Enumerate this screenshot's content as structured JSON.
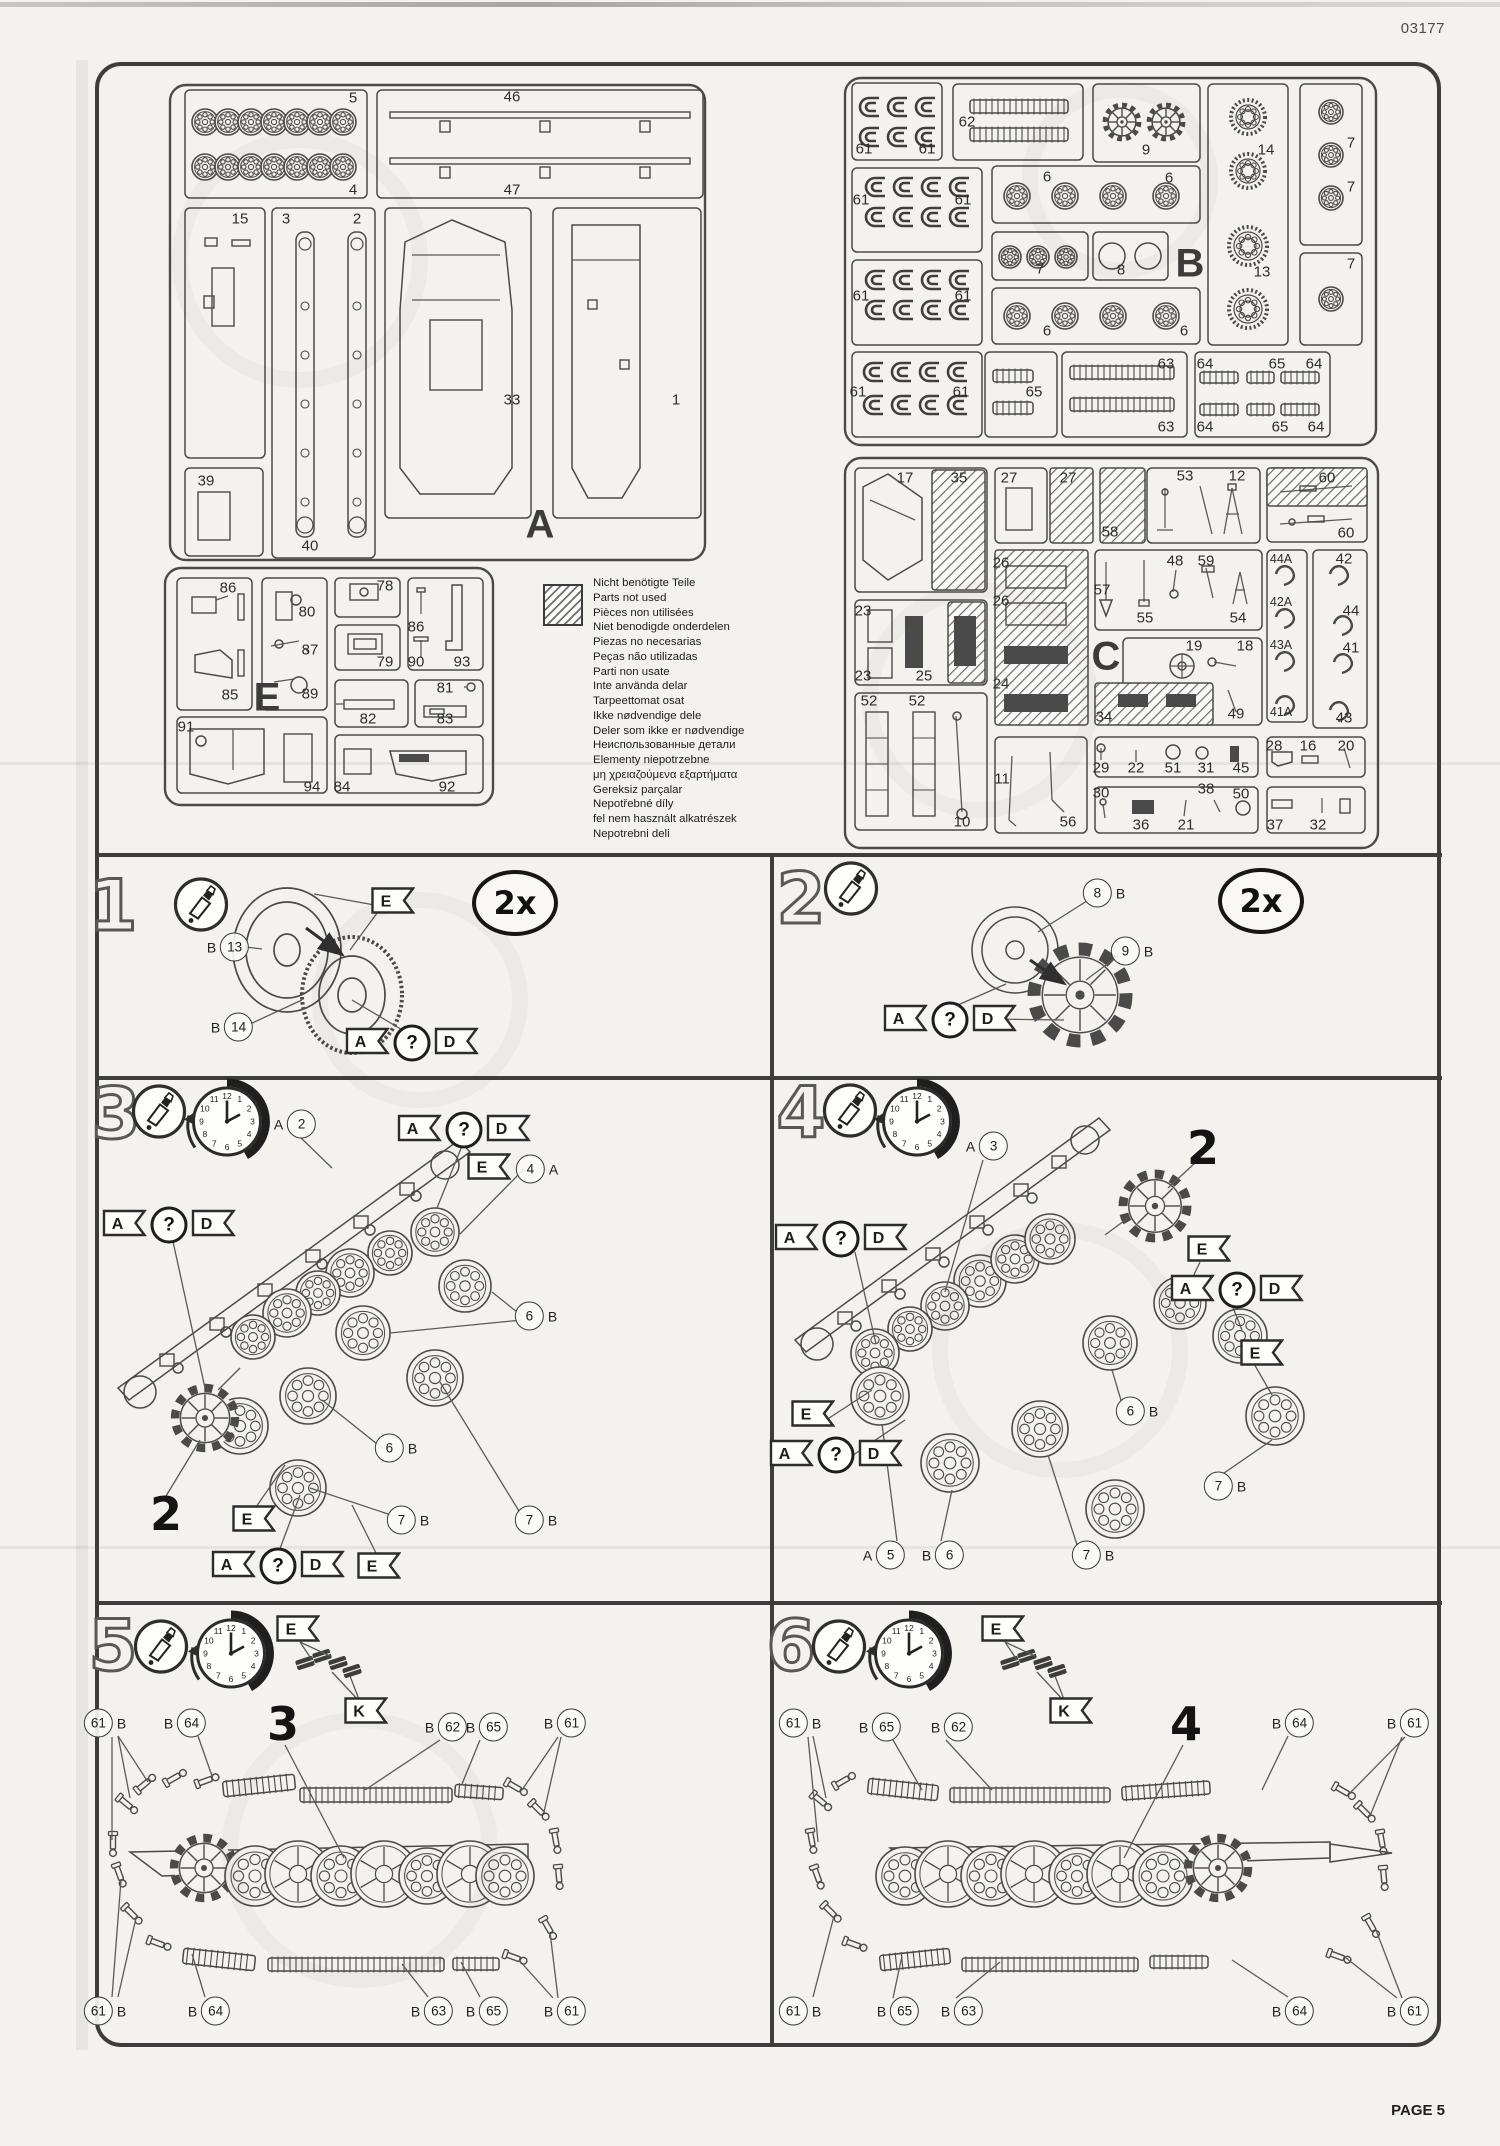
{
  "page": {
    "kit_number": "03177",
    "page_label": "PAGE 5"
  },
  "colors": {
    "paper": "#f4f2ee",
    "ink": "#3d3d3d"
  },
  "legend": {
    "icon": "hatched-square",
    "lines": [
      "Nicht benötigte Teile",
      "Parts not used",
      "Pièces non utilisées",
      "Niet benodigde onderdelen",
      "Piezas no necesarias",
      "Peças não utilizadas",
      "Parti non usate",
      "Inte använda delar",
      "Tarpeettomat osat",
      "Ikke nødvendige dele",
      "Deler som ikke er nødvendige",
      "Неиспользованные детали",
      "Elementy niepotrzebne",
      "μη χρειαζούμενα εξαρτήματα",
      "Gereksiz parçalar",
      "Nepotřebné díly",
      "fel nem használt alkatrészek",
      "Nepotrebni deli"
    ]
  },
  "sprues": [
    {
      "id": "A",
      "letter": "A",
      "lx": 540,
      "ly": 525,
      "labels": [
        [
          "5",
          353,
          98
        ],
        [
          "4",
          353,
          190
        ],
        [
          "46",
          512,
          97
        ],
        [
          "47",
          512,
          190
        ],
        [
          "15",
          240,
          219
        ],
        [
          "3",
          286,
          219
        ],
        [
          "2",
          357,
          219
        ],
        [
          "33",
          512,
          400
        ],
        [
          "1",
          676,
          400
        ],
        [
          "39",
          206,
          481
        ],
        [
          "40",
          310,
          546
        ]
      ]
    },
    {
      "id": "B",
      "letter": "B",
      "lx": 1190,
      "ly": 264,
      "labels": [
        [
          "61",
          864,
          149
        ],
        [
          "61",
          927,
          149
        ],
        [
          "62",
          967,
          122
        ],
        [
          "9",
          1146,
          150
        ],
        [
          "14",
          1266,
          150
        ],
        [
          "13",
          1262,
          272
        ],
        [
          "7",
          1351,
          143
        ],
        [
          "7",
          1351,
          187
        ],
        [
          "7",
          1351,
          264
        ],
        [
          "61",
          861,
          200
        ],
        [
          "61",
          963,
          200
        ],
        [
          "6",
          1047,
          177
        ],
        [
          "6",
          1169,
          178
        ],
        [
          "7",
          1040,
          269
        ],
        [
          "8",
          1121,
          270
        ],
        [
          "61",
          861,
          296
        ],
        [
          "61",
          963,
          296
        ],
        [
          "6",
          1047,
          331
        ],
        [
          "6",
          1184,
          331
        ],
        [
          "61",
          858,
          392
        ],
        [
          "61",
          961,
          392
        ],
        [
          "65",
          1034,
          392
        ],
        [
          "63",
          1166,
          364
        ],
        [
          "63",
          1166,
          427
        ],
        [
          "64",
          1205,
          364
        ],
        [
          "65",
          1277,
          364
        ],
        [
          "64",
          1314,
          364
        ],
        [
          "64",
          1205,
          427
        ],
        [
          "65",
          1280,
          427
        ],
        [
          "64",
          1316,
          427
        ]
      ]
    },
    {
      "id": "C",
      "letter": "C",
      "lx": 1106,
      "ly": 657,
      "labels": [
        [
          "17",
          905,
          478
        ],
        [
          "35",
          959,
          478
        ],
        [
          "27",
          1009,
          478
        ],
        [
          "27",
          1068,
          478
        ],
        [
          "58",
          1110,
          532
        ],
        [
          "53",
          1185,
          476
        ],
        [
          "12",
          1237,
          476
        ],
        [
          "60",
          1327,
          478
        ],
        [
          "60",
          1346,
          533
        ],
        [
          "23",
          863,
          611
        ],
        [
          "23",
          863,
          676
        ],
        [
          "25",
          924,
          676
        ],
        [
          "26",
          1001,
          563
        ],
        [
          "26",
          1001,
          601
        ],
        [
          "24",
          1001,
          684
        ],
        [
          "57",
          1102,
          590
        ],
        [
          "48",
          1175,
          561
        ],
        [
          "59",
          1206,
          561
        ],
        [
          "55",
          1145,
          618
        ],
        [
          "54",
          1238,
          618
        ],
        [
          "19",
          1194,
          646
        ],
        [
          "18",
          1245,
          646
        ],
        [
          "49",
          1236,
          714
        ],
        [
          "34",
          1104,
          717
        ],
        [
          "52",
          869,
          701
        ],
        [
          "52",
          917,
          701
        ],
        [
          "10",
          962,
          822
        ],
        [
          "11",
          1002,
          779
        ],
        [
          "56",
          1068,
          822
        ],
        [
          "29",
          1101,
          768
        ],
        [
          "22",
          1136,
          768
        ],
        [
          "51",
          1173,
          768
        ],
        [
          "31",
          1206,
          768
        ],
        [
          "45",
          1241,
          768
        ],
        [
          "28",
          1274,
          746
        ],
        [
          "16",
          1308,
          746
        ],
        [
          "20",
          1346,
          746
        ],
        [
          "30",
          1101,
          793
        ],
        [
          "38",
          1206,
          789
        ],
        [
          "50",
          1241,
          794
        ],
        [
          "36",
          1141,
          825
        ],
        [
          "21",
          1186,
          825
        ],
        [
          "37",
          1275,
          825
        ],
        [
          "32",
          1318,
          825
        ],
        [
          "44A",
          1281,
          559
        ],
        [
          "42A",
          1281,
          602
        ],
        [
          "43A",
          1281,
          645
        ],
        [
          "41A",
          1281,
          712
        ],
        [
          "42",
          1344,
          559
        ],
        [
          "44",
          1351,
          611
        ],
        [
          "41",
          1351,
          648
        ],
        [
          "43",
          1344,
          718
        ]
      ]
    },
    {
      "id": "E",
      "letter": "E",
      "lx": 267,
      "ly": 698,
      "labels": [
        [
          "86",
          228,
          588
        ],
        [
          "85",
          230,
          695
        ],
        [
          "80",
          307,
          612
        ],
        [
          "87",
          310,
          650
        ],
        [
          "89",
          310,
          694
        ],
        [
          "78",
          385,
          586
        ],
        [
          "79",
          385,
          662
        ],
        [
          "86",
          416,
          627
        ],
        [
          "90",
          416,
          662
        ],
        [
          "93",
          462,
          662
        ],
        [
          "82",
          368,
          719
        ],
        [
          "81",
          445,
          688
        ],
        [
          "83",
          445,
          719
        ],
        [
          "91",
          186,
          727
        ],
        [
          "94",
          312,
          787
        ],
        [
          "84",
          342,
          787
        ],
        [
          "92",
          447,
          787
        ]
      ]
    }
  ],
  "steps": [
    {
      "n": "1",
      "items": [
        {
          "k": "num",
          "t": "1",
          "x": 113,
          "y": 906
        },
        {
          "k": "glue",
          "x": 201,
          "y": 907
        },
        {
          "k": "callout",
          "pre": "B",
          "num": "13",
          "x": 228,
          "y": 947
        },
        {
          "k": "callout",
          "pre": "B",
          "num": "14",
          "x": 232,
          "y": 1027
        },
        {
          "k": "flag",
          "letters": [
            "E"
          ],
          "x": 393,
          "y": 903
        },
        {
          "k": "flag",
          "letters": [
            "A",
            "?",
            "D"
          ],
          "x": 412,
          "y": 1043
        },
        {
          "k": "mult",
          "t": "2x",
          "x": 515,
          "y": 903
        }
      ]
    },
    {
      "n": "2",
      "items": [
        {
          "k": "num",
          "t": "2",
          "x": 801,
          "y": 899
        },
        {
          "k": "glue",
          "x": 851,
          "y": 891
        },
        {
          "k": "callout",
          "num": "8",
          "post": "B",
          "x": 1104,
          "y": 893
        },
        {
          "k": "callout",
          "num": "9",
          "post": "B",
          "x": 1132,
          "y": 951
        },
        {
          "k": "flag",
          "letters": [
            "A",
            "?",
            "D"
          ],
          "x": 950,
          "y": 1020
        },
        {
          "k": "mult",
          "t": "2x",
          "x": 1261,
          "y": 901
        }
      ]
    },
    {
      "n": "3",
      "items": [
        {
          "k": "num",
          "t": "3",
          "x": 116,
          "y": 1114
        },
        {
          "k": "glue",
          "x": 159,
          "y": 1114
        },
        {
          "k": "clock",
          "x": 227,
          "y": 1126
        },
        {
          "k": "callout",
          "pre": "A",
          "num": "2",
          "x": 295,
          "y": 1124
        },
        {
          "k": "flag",
          "letters": [
            "A",
            "?",
            "D"
          ],
          "x": 464,
          "y": 1130
        },
        {
          "k": "flag",
          "letters": [
            "E"
          ],
          "x": 489,
          "y": 1169
        },
        {
          "k": "callout",
          "num": "4",
          "post": "A",
          "x": 537,
          "y": 1169
        },
        {
          "k": "flag",
          "letters": [
            "A",
            "?",
            "D"
          ],
          "x": 169,
          "y": 1225
        },
        {
          "k": "callout",
          "num": "6",
          "post": "B",
          "x": 536,
          "y": 1316
        },
        {
          "k": "callout",
          "num": "6",
          "post": "B",
          "x": 396,
          "y": 1448
        },
        {
          "k": "callout",
          "num": "7",
          "post": "B",
          "x": 408,
          "y": 1520
        },
        {
          "k": "callout",
          "num": "7",
          "post": "B",
          "x": 536,
          "y": 1520
        },
        {
          "k": "flag",
          "letters": [
            "E"
          ],
          "x": 254,
          "y": 1521
        },
        {
          "k": "flag",
          "letters": [
            "A",
            "?",
            "D"
          ],
          "x": 278,
          "y": 1566
        },
        {
          "k": "flag",
          "letters": [
            "E"
          ],
          "x": 379,
          "y": 1568
        },
        {
          "k": "ref",
          "t": "2",
          "x": 166,
          "y": 1514
        }
      ]
    },
    {
      "n": "4",
      "items": [
        {
          "k": "num",
          "t": "4",
          "x": 801,
          "y": 1113
        },
        {
          "k": "glue",
          "x": 850,
          "y": 1113
        },
        {
          "k": "clock",
          "x": 917,
          "y": 1126
        },
        {
          "k": "callout",
          "pre": "A",
          "num": "3",
          "x": 987,
          "y": 1146
        },
        {
          "k": "ref",
          "t": "2",
          "x": 1203,
          "y": 1148
        },
        {
          "k": "flag",
          "letters": [
            "A",
            "?",
            "D"
          ],
          "x": 841,
          "y": 1239
        },
        {
          "k": "flag",
          "letters": [
            "E"
          ],
          "x": 1209,
          "y": 1251
        },
        {
          "k": "flag",
          "letters": [
            "A",
            "?",
            "D"
          ],
          "x": 1237,
          "y": 1290
        },
        {
          "k": "flag",
          "letters": [
            "E"
          ],
          "x": 1262,
          "y": 1355
        },
        {
          "k": "callout",
          "num": "6",
          "post": "B",
          "x": 1137,
          "y": 1411
        },
        {
          "k": "callout",
          "num": "7",
          "post": "B",
          "x": 1225,
          "y": 1486
        },
        {
          "k": "callout",
          "num": "7",
          "post": "B",
          "x": 1093,
          "y": 1555
        },
        {
          "k": "callout",
          "pre": "A",
          "num": "5",
          "x": 884,
          "y": 1555
        },
        {
          "k": "callout",
          "pre": "B",
          "num": "6",
          "x": 943,
          "y": 1555
        },
        {
          "k": "flag",
          "letters": [
            "E"
          ],
          "x": 813,
          "y": 1416
        },
        {
          "k": "flag",
          "letters": [
            "A",
            "?",
            "D"
          ],
          "x": 836,
          "y": 1455
        }
      ]
    },
    {
      "n": "5",
      "items": [
        {
          "k": "num",
          "t": "5",
          "x": 113,
          "y": 1646
        },
        {
          "k": "glue",
          "x": 161,
          "y": 1649
        },
        {
          "k": "clock",
          "x": 231,
          "y": 1658
        },
        {
          "k": "flag",
          "letters": [
            "E"
          ],
          "x": 298,
          "y": 1631
        },
        {
          "k": "flag",
          "letters": [
            "K"
          ],
          "x": 366,
          "y": 1713
        },
        {
          "k": "ref",
          "t": "3",
          "x": 283,
          "y": 1724
        },
        {
          "k": "callout",
          "num": "61",
          "post": "B",
          "x": 105,
          "y": 1723
        },
        {
          "k": "callout",
          "pre": "B",
          "num": "64",
          "x": 185,
          "y": 1723
        },
        {
          "k": "callout",
          "pre": "B",
          "num": "62",
          "x": 446,
          "y": 1727
        },
        {
          "k": "callout",
          "pre": "B",
          "num": "65",
          "x": 487,
          "y": 1727
        },
        {
          "k": "callout",
          "pre": "B",
          "num": "61",
          "x": 565,
          "y": 1723
        },
        {
          "k": "callout",
          "num": "61",
          "post": "B",
          "x": 105,
          "y": 2011
        },
        {
          "k": "callout",
          "pre": "B",
          "num": "64",
          "x": 209,
          "y": 2011
        },
        {
          "k": "callout",
          "pre": "B",
          "num": "63",
          "x": 432,
          "y": 2011
        },
        {
          "k": "callout",
          "pre": "B",
          "num": "65",
          "x": 487,
          "y": 2011
        },
        {
          "k": "callout",
          "pre": "B",
          "num": "61",
          "x": 565,
          "y": 2011
        }
      ]
    },
    {
      "n": "6",
      "items": [
        {
          "k": "num",
          "t": "6",
          "x": 791,
          "y": 1646
        },
        {
          "k": "glue",
          "x": 839,
          "y": 1649
        },
        {
          "k": "clock",
          "x": 909,
          "y": 1658
        },
        {
          "k": "flag",
          "letters": [
            "E"
          ],
          "x": 1003,
          "y": 1631
        },
        {
          "k": "flag",
          "letters": [
            "K"
          ],
          "x": 1071,
          "y": 1713
        },
        {
          "k": "ref",
          "t": "4",
          "x": 1186,
          "y": 1724
        },
        {
          "k": "callout",
          "num": "61",
          "post": "B",
          "x": 800,
          "y": 1723
        },
        {
          "k": "callout",
          "pre": "B",
          "num": "65",
          "x": 880,
          "y": 1727
        },
        {
          "k": "callout",
          "pre": "B",
          "num": "62",
          "x": 952,
          "y": 1727
        },
        {
          "k": "callout",
          "pre": "B",
          "num": "64",
          "x": 1293,
          "y": 1723
        },
        {
          "k": "callout",
          "pre": "B",
          "num": "61",
          "x": 1408,
          "y": 1723
        },
        {
          "k": "callout",
          "num": "61",
          "post": "B",
          "x": 800,
          "y": 2011
        },
        {
          "k": "callout",
          "pre": "B",
          "num": "65",
          "x": 898,
          "y": 2011
        },
        {
          "k": "callout",
          "pre": "B",
          "num": "63",
          "x": 962,
          "y": 2011
        },
        {
          "k": "callout",
          "pre": "B",
          "num": "64",
          "x": 1293,
          "y": 2011
        },
        {
          "k": "callout",
          "pre": "B",
          "num": "61",
          "x": 1408,
          "y": 2011
        }
      ]
    }
  ]
}
